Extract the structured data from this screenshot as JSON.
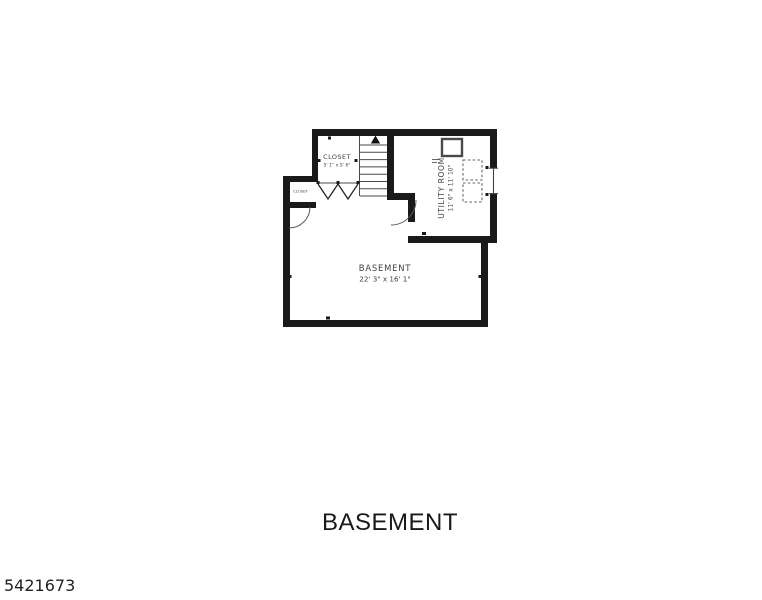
{
  "title": "BASEMENT",
  "photo_id": "5421673",
  "colors": {
    "background": "#ffffff",
    "walls": "#1a1a1a",
    "room_text": "#3f3f3f",
    "title_text": "#1a1a1a"
  },
  "plan": {
    "rooms": {
      "basement": {
        "name": "BASEMENT",
        "dims": "22' 3\" x 16' 1\""
      },
      "closet": {
        "name": "CLOSET",
        "dims": "5' 1\" x 5' 6\""
      },
      "small_closet": {
        "name": "CLOSET"
      },
      "utility": {
        "name": "UTILITY ROOM",
        "dims": "11' 6\" x 11' 10\""
      }
    },
    "features": {
      "stairs": "stairs-up-arrow",
      "closet_doors": "bifold-doors",
      "basement_doors": "swing-door-arcs",
      "utility_window": "window",
      "utility_equipment": "dashed-equipment-squares"
    }
  }
}
